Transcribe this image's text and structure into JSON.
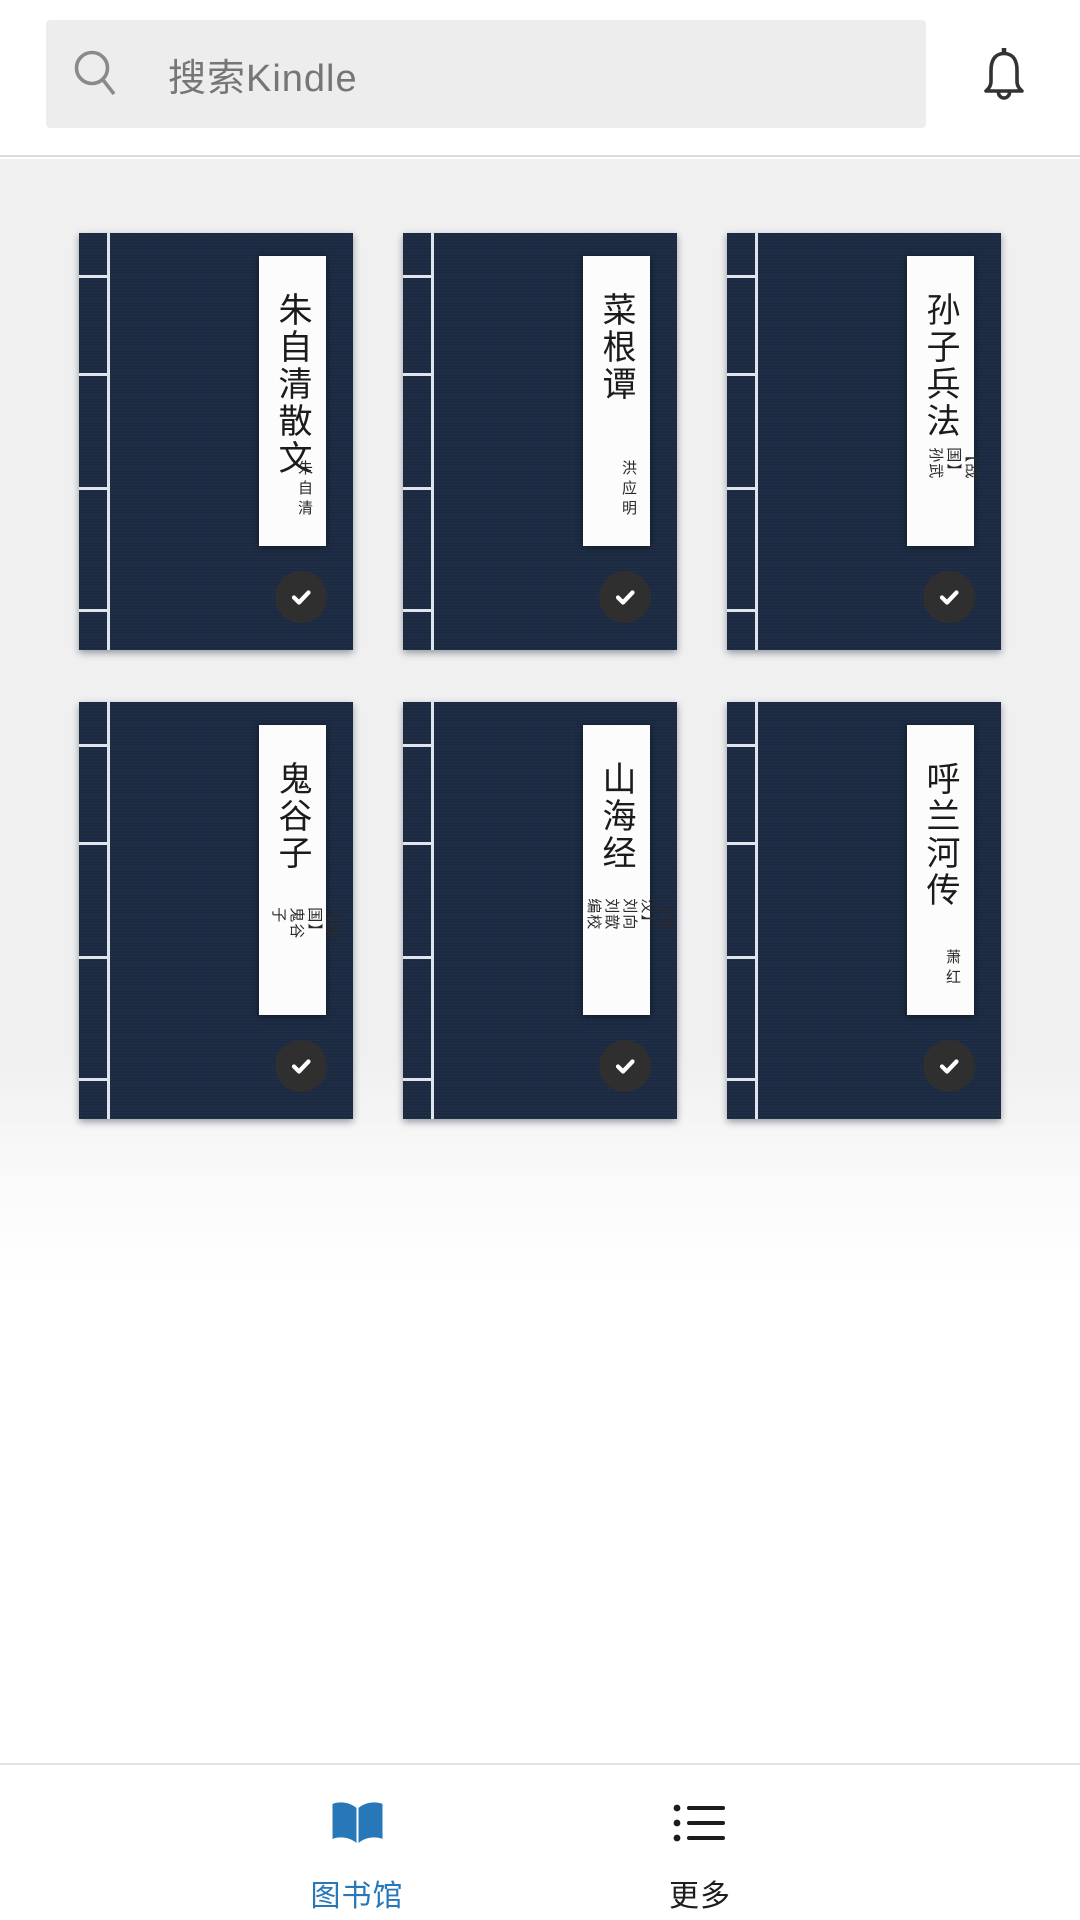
{
  "header": {
    "search_placeholder": "搜索Kindle",
    "search_icon": "magnifier-icon",
    "notification_icon": "bell-icon"
  },
  "books": [
    {
      "title": "朱自清散文",
      "author": "朱自清",
      "author_style": "upright",
      "downloaded": true
    },
    {
      "title": "菜根谭",
      "author": "洪应明",
      "author_style": "upright",
      "downloaded": true
    },
    {
      "title": "孙子兵法",
      "author": "【战国】孙武",
      "author_style": "rotated",
      "downloaded": true
    },
    {
      "title": "鬼谷子",
      "author": "【战国】鬼谷子",
      "author_style": "rotated",
      "downloaded": true
    },
    {
      "title": "山海经",
      "author": "【西汉】刘向\n刘歆 编校",
      "author_style": "rotated",
      "downloaded": true
    },
    {
      "title": "呼兰河传",
      "author": "萧红",
      "author_style": "upright",
      "downloaded": true
    }
  ],
  "nav": {
    "tabs": [
      {
        "label": "图书馆",
        "icon": "open-book-icon",
        "active": true
      },
      {
        "label": "更多",
        "icon": "list-icon",
        "active": false
      }
    ]
  },
  "colors": {
    "accent_blue": "#2878b9",
    "cover_navy": "#1c2b43",
    "badge_gray": "#2f2f2f",
    "search_bar_bg": "#ededee",
    "content_gray": "#f0f0f1"
  }
}
